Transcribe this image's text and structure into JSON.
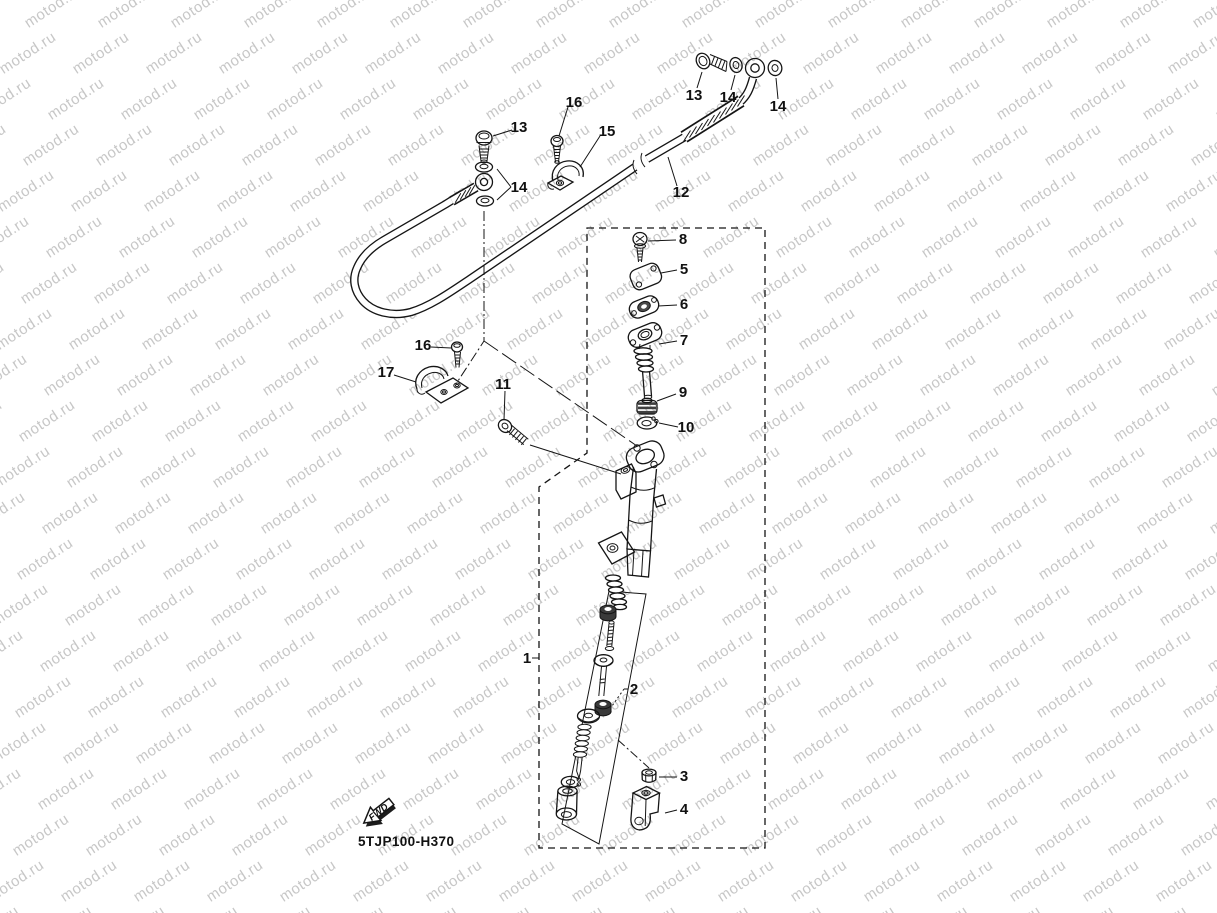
{
  "watermark": {
    "text": "motod.ru",
    "color": "#c7c7c7"
  },
  "footer": {
    "diagram_code": "5TJP100-H370",
    "fwd_label": "FWD"
  },
  "callouts": [
    {
      "part": "13"
    },
    {
      "part": "14"
    },
    {
      "part": "14"
    },
    {
      "part": "12"
    },
    {
      "part": "16"
    },
    {
      "part": "13"
    },
    {
      "part": "15"
    },
    {
      "part": "14"
    },
    {
      "part": "8"
    },
    {
      "part": "5"
    },
    {
      "part": "6"
    },
    {
      "part": "7"
    },
    {
      "part": "9"
    },
    {
      "part": "10"
    },
    {
      "part": "16"
    },
    {
      "part": "17"
    },
    {
      "part": "11"
    },
    {
      "part": "1"
    },
    {
      "part": "2"
    },
    {
      "part": "3"
    },
    {
      "part": "4"
    }
  ]
}
